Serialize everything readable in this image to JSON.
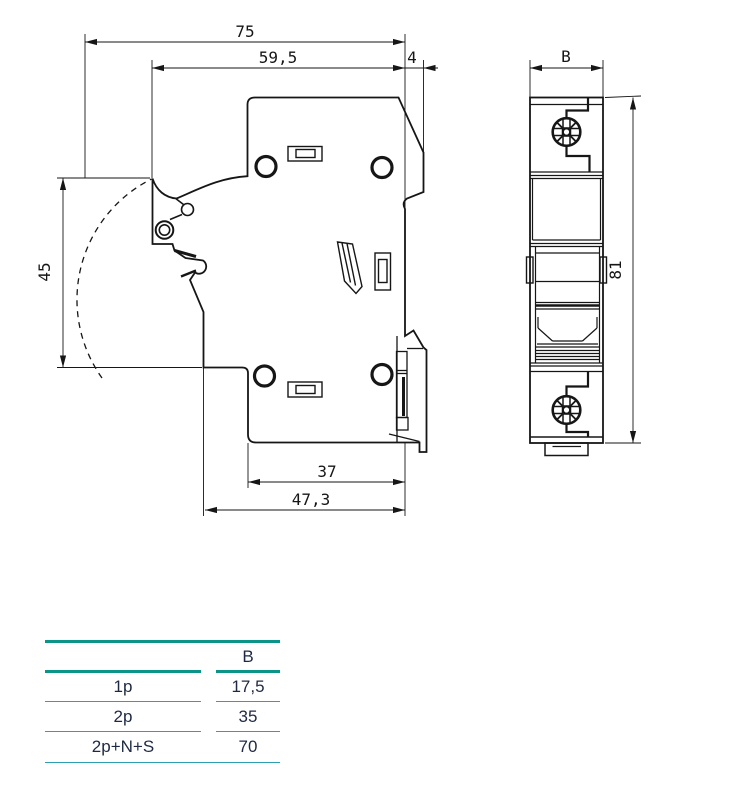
{
  "drawing": {
    "side_view": {
      "dims": {
        "width_total": "75",
        "width_body": "59,5",
        "rail_lip": "4",
        "handle_height": "45",
        "depth_inner": "37",
        "depth_total": "47,3"
      }
    },
    "front_view": {
      "dims": {
        "width": "B",
        "height": "81"
      }
    }
  },
  "table": {
    "header": [
      "",
      "B"
    ],
    "rows": [
      {
        "label": "1p",
        "value": "17,5"
      },
      {
        "label": "2p",
        "value": "35"
      },
      {
        "label": "2p+N+S",
        "value": "70"
      }
    ],
    "colors": {
      "thick_rule": "#0D9488",
      "thin_rule": "#2E9FAE",
      "text": "#1D2944",
      "line_art": "#161616"
    }
  }
}
